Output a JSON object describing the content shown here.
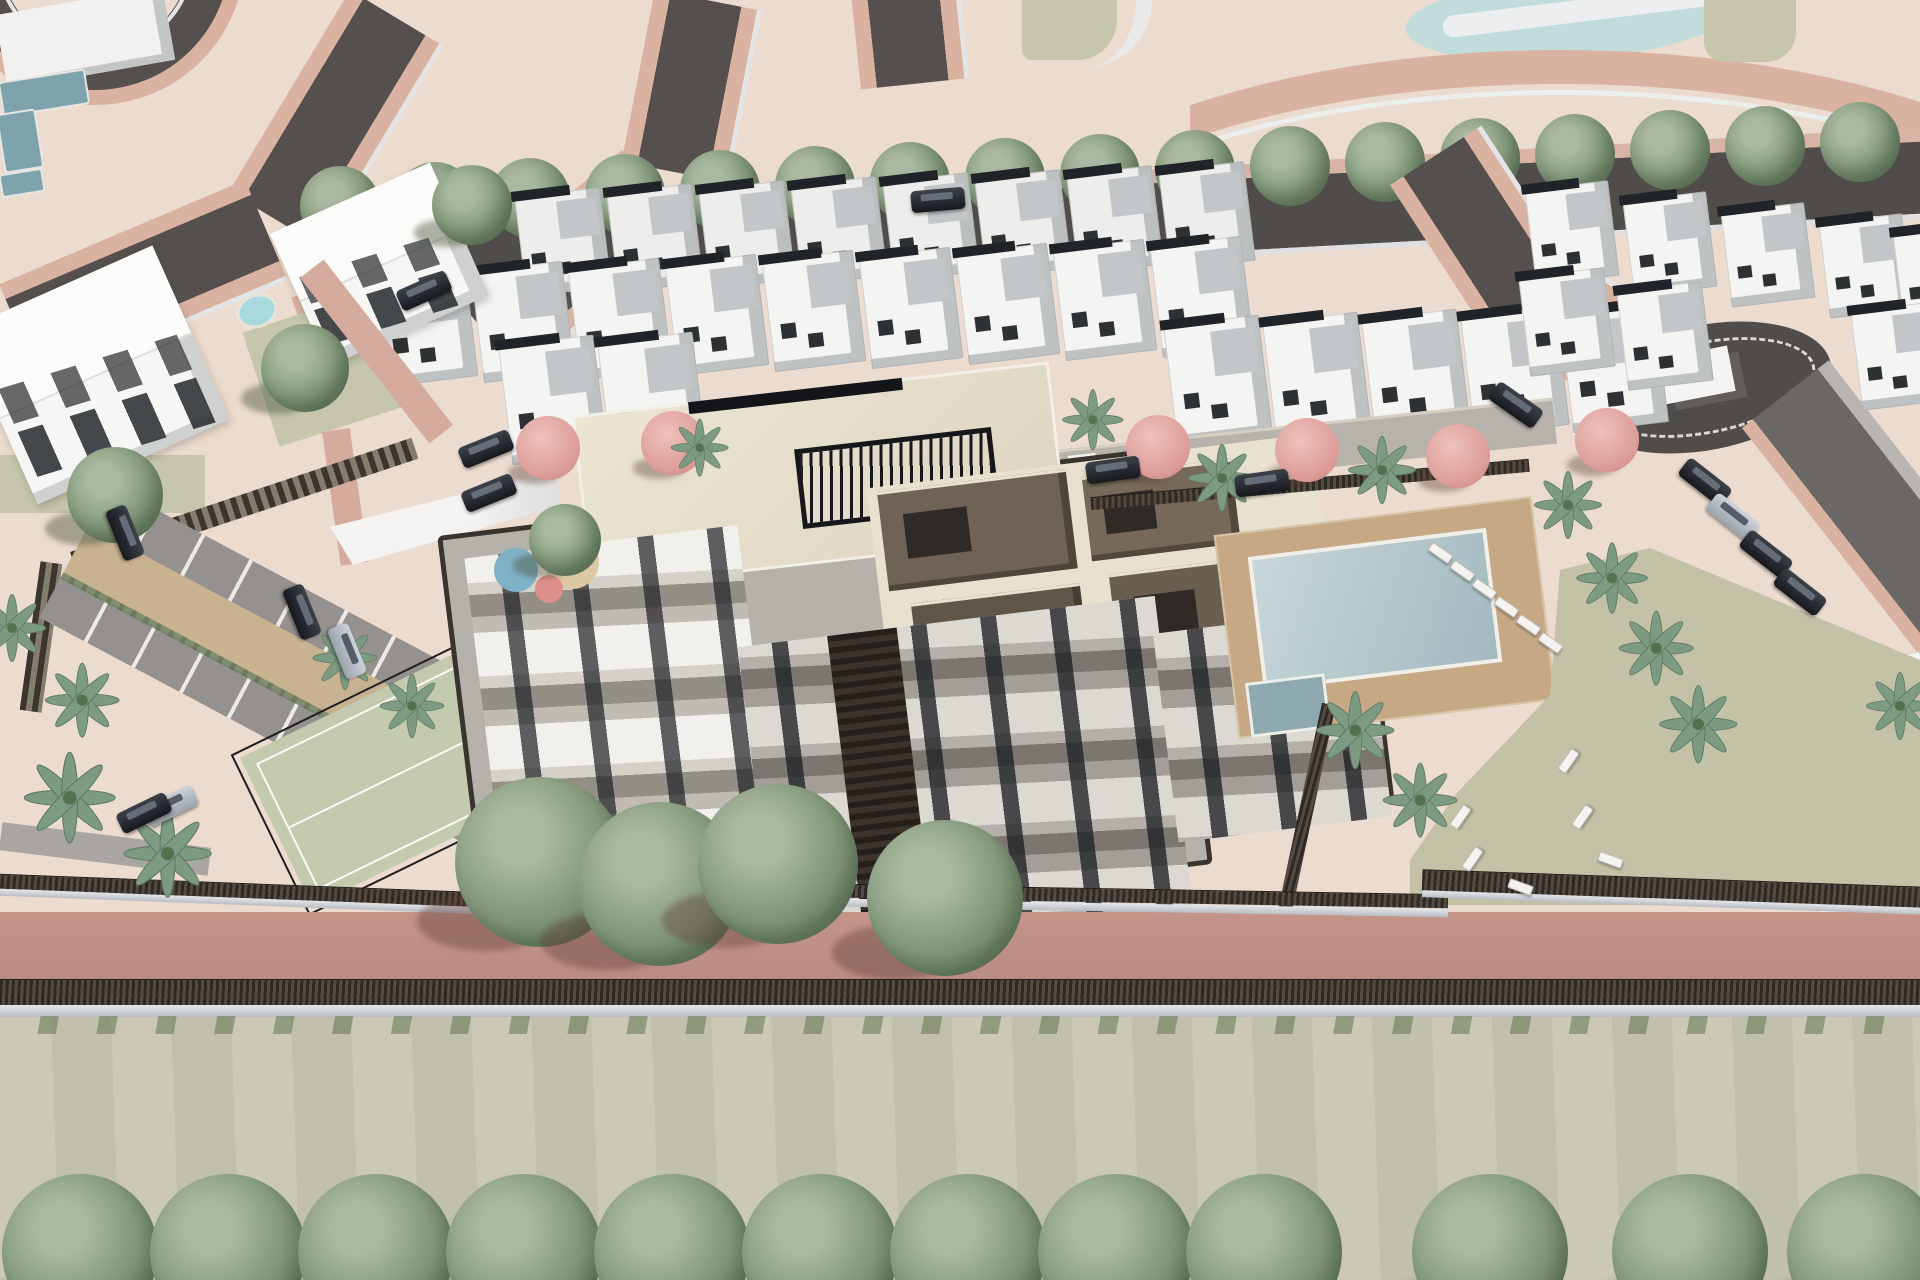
{
  "scene": {
    "type": "3d-aerial-architectural-render",
    "subject": "residential-development-masterplan"
  },
  "palette": {
    "ground_cream": "#ecdccf",
    "road_asphalt": "#55504e",
    "road_edge_pink": "#d9b2a2",
    "sidewalk_white": "#e3e3e5",
    "boulevard": "#504c4a",
    "villa_white": "#f4f4f2",
    "villa_roof_grey": "#c2c6c9",
    "roof_strip_dark": "#202327",
    "building_cream": "#e9e2d0",
    "building_brown": "#6e6356",
    "building_band_grey": "#938e86",
    "window_dark": "#2e3134",
    "pool_blue": "#aec7cd",
    "deck_tan": "#c5a784",
    "lawn_green": "#c7c5b0",
    "court_green": "#c3caae",
    "hedge_dark": "#3a332c",
    "walk_pink": "#bf9188",
    "pond_blue": "#c2dcdc",
    "tree_green": "#7f957a",
    "palm_green": "#7d9b82",
    "tree_pink": "#dfa09c",
    "car_dark": "#23252b",
    "car_silver": "#b7bec8",
    "play_blue": "#7fb2c6",
    "play_red": "#dd8f8c",
    "play_sand": "#dcc9a2"
  },
  "inventory": {
    "boulevard_trees": {
      "x_start": 340,
      "x_step": 95,
      "count": 17,
      "y_at_start": 206,
      "y_slope": -0.042,
      "r": 40
    },
    "misc_trees": [
      [
        472,
        205,
        40
      ],
      [
        305,
        368,
        44
      ],
      [
        115,
        495,
        48
      ],
      [
        565,
        540,
        36
      ]
    ],
    "front_trees": [
      [
        540,
        862,
        85
      ],
      [
        660,
        884,
        82
      ],
      [
        778,
        864,
        80
      ],
      [
        945,
        898,
        78
      ]
    ],
    "bottom_trees": {
      "y": 1252,
      "r": 78,
      "x": [
        80,
        228,
        376,
        524,
        672,
        820,
        968,
        1116,
        1264,
        1490,
        1690,
        1865
      ]
    },
    "pink_trees": [
      [
        548,
        448
      ],
      [
        673,
        443
      ],
      [
        1158,
        447
      ],
      [
        1307,
        450
      ],
      [
        1458,
        456
      ],
      [
        1607,
        440
      ]
    ],
    "palms": [
      [
        12,
        628,
        1
      ],
      [
        82,
        700,
        1.1
      ],
      [
        70,
        798,
        1.35
      ],
      [
        168,
        854,
        1.3
      ],
      [
        345,
        658,
        0.95
      ],
      [
        412,
        706,
        0.95
      ],
      [
        700,
        448,
        0.85
      ],
      [
        1093,
        420,
        0.9
      ],
      [
        1222,
        478,
        1
      ],
      [
        1382,
        470,
        1
      ],
      [
        1355,
        730,
        1.15
      ],
      [
        1420,
        800,
        1.1
      ],
      [
        1568,
        505,
        1
      ],
      [
        1612,
        578,
        1.05
      ],
      [
        1656,
        648,
        1.1
      ],
      [
        1698,
        724,
        1.15
      ],
      [
        1900,
        706,
        1
      ]
    ],
    "villas": {
      "row_back": {
        "x_start": 520,
        "x_step": 92,
        "count": 8,
        "y_at_start": 192,
        "y_slope": -0.04,
        "w": 86,
        "h": 100
      },
      "row_mid": {
        "x_start": 380,
        "x_step": 97,
        "count": 9,
        "y_at_start": 270,
        "y_slope": -0.038,
        "w": 92,
        "h": 112
      },
      "row_front_x": [
        505,
        604,
        1170,
        1269,
        1368,
        1467,
        1566
      ],
      "row_front_y": [
        340,
        337,
        320,
        317,
        314,
        311,
        308
      ],
      "front_w": 96,
      "front_h": 120,
      "right_upper": [
        [
          1530,
          185
        ],
        [
          1628,
          196
        ],
        [
          1726,
          207
        ],
        [
          1824,
          218
        ],
        [
          1898,
          228
        ]
      ],
      "right_lower": [
        [
          1524,
          272
        ],
        [
          1622,
          286
        ],
        [
          1856,
          306
        ]
      ],
      "south_east": [
        [
          1700,
          622
        ],
        [
          1828,
          658
        ],
        [
          1678,
          762
        ],
        [
          1812,
          812
        ]
      ]
    },
    "cars": [
      [
        125,
        533,
        68,
        "dark"
      ],
      [
        302,
        612,
        68,
        "dark"
      ],
      [
        347,
        651,
        68,
        "silver"
      ],
      [
        170,
        806,
        -26,
        "silver"
      ],
      [
        144,
        813,
        -26,
        "dark"
      ],
      [
        486,
        449,
        -22,
        "dark"
      ],
      [
        489,
        493,
        -22,
        "dark"
      ],
      [
        424,
        291,
        -24,
        "dark"
      ],
      [
        938,
        200,
        -5,
        "dark"
      ],
      [
        1113,
        470,
        -8,
        "dark"
      ],
      [
        1262,
        483,
        -8,
        "dark"
      ],
      [
        1516,
        405,
        35,
        "dark"
      ],
      [
        1705,
        482,
        38,
        "dark"
      ],
      [
        1733,
        517,
        38,
        "silver"
      ],
      [
        1766,
        554,
        38,
        "dark"
      ],
      [
        1800,
        592,
        38,
        "dark"
      ]
    ],
    "loungers": [
      [
        1428,
        548,
        35
      ],
      [
        1450,
        566,
        35
      ],
      [
        1472,
        584,
        35
      ],
      [
        1494,
        602,
        35
      ],
      [
        1516,
        620,
        35
      ],
      [
        1538,
        638,
        35
      ],
      [
        1556,
        756,
        -55
      ],
      [
        1570,
        812,
        -55
      ],
      [
        1598,
        855,
        20
      ],
      [
        1448,
        812,
        -55
      ],
      [
        1460,
        854,
        -55
      ],
      [
        1508,
        882,
        20
      ]
    ],
    "pools": {
      "main": [
        1255,
        542,
        240,
        135
      ],
      "spa": [
        1248,
        678,
        80,
        55
      ],
      "kidney": [
        236,
        294,
        42,
        34
      ],
      "plot_pools": [
        [
          1612,
          632,
          88,
          36
        ],
        [
          1884,
          650,
          40,
          60
        ],
        [
          1860,
          345,
          44,
          24
        ]
      ]
    },
    "playground": {
      "sand": [
        572,
        562,
        27
      ],
      "blue": [
        516,
        570,
        22
      ],
      "red": [
        549,
        589,
        14
      ]
    }
  }
}
